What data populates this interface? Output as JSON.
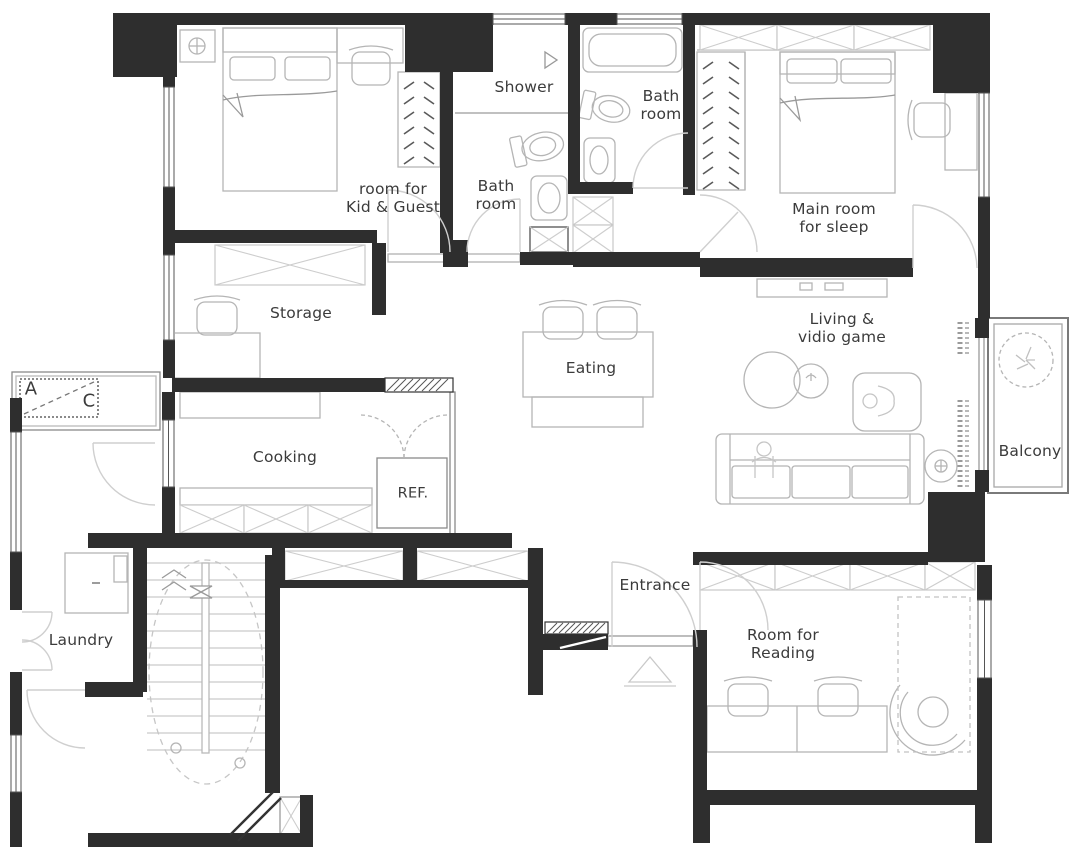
{
  "plan": {
    "type": "apartment-floor-plan",
    "colors": {
      "wall": "#2e2e2e",
      "furniture_line": "#b5b5b5",
      "door_line": "#cccccc",
      "text": "#3b3b3b",
      "background": "#ffffff"
    },
    "rooms": {
      "kid_guest": {
        "l1": "room for",
        "l2": "Kid & Guest"
      },
      "shower": {
        "l1": "Shower"
      },
      "bath_inner": {
        "l1": "Bath",
        "l2": "room"
      },
      "bath_main": {
        "l1": "Bath",
        "l2": "room"
      },
      "main_sleep": {
        "l1": "Main room",
        "l2": "for sleep"
      },
      "storage": {
        "l1": "Storage"
      },
      "eating": {
        "l1": "Eating"
      },
      "living": {
        "l1": "Living &",
        "l2": "vidio game"
      },
      "balcony": {
        "l1": "Balcony"
      },
      "cooking": {
        "l1": "Cooking"
      },
      "ref": {
        "l1": "REF."
      },
      "entrance": {
        "l1": "Entrance"
      },
      "laundry": {
        "l1": "Laundry"
      },
      "reading": {
        "l1": "Room for",
        "l2": "Reading"
      },
      "ac_a": {
        "l1": "A"
      },
      "ac_c": {
        "l1": "C"
      }
    }
  }
}
